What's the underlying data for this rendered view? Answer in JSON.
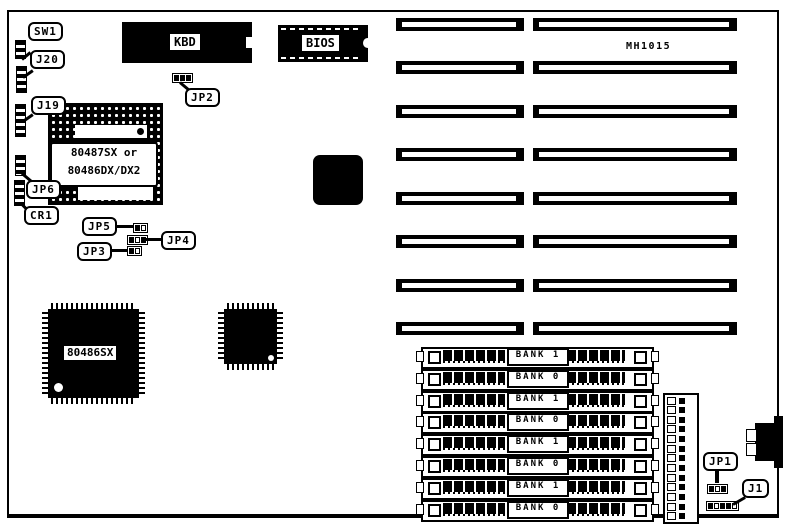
{
  "board_id": "MH1015",
  "labels": {
    "sw1": "SW1",
    "j20": "J20",
    "j19": "J19",
    "jp6": "JP6",
    "cr1": "CR1",
    "jp5": "JP5",
    "jp4": "JP4",
    "jp3": "JP3",
    "jp2": "JP2",
    "jp1": "JP1",
    "j1": "J1"
  },
  "chips": {
    "kbd": "KBD",
    "bios": "BIOS",
    "cpu_socket_line1": "80487SX or",
    "cpu_socket_line2": "80486DX/DX2",
    "cpu": "80486SX"
  },
  "memory": {
    "banks": [
      "BANK 1",
      "BANK 0",
      "BANK 1",
      "BANK 0",
      "BANK 1",
      "BANK 0",
      "BANK 1",
      "BANK 0"
    ]
  },
  "isa_slots": {
    "count": 8
  },
  "pin_header": {
    "rows": 13
  },
  "colors": {
    "ink": "#000000",
    "paper": "#ffffff"
  }
}
